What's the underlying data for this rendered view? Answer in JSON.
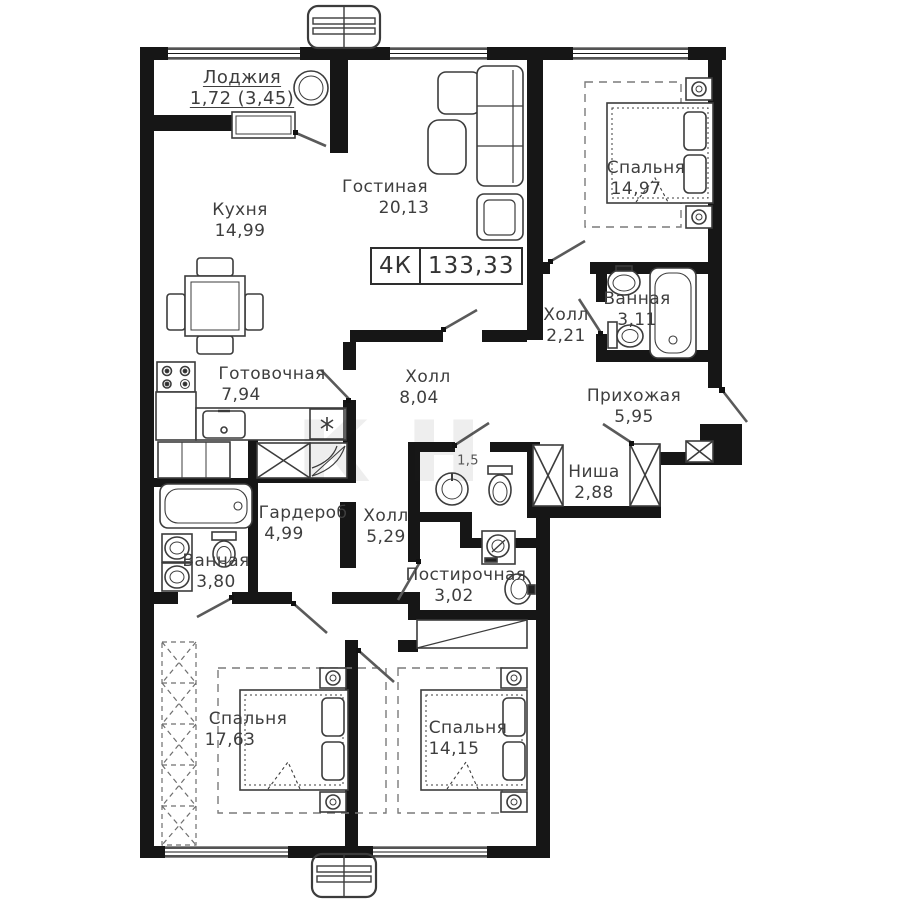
{
  "plan": {
    "badge": {
      "type": "4К",
      "area": "133,33"
    },
    "watermark": "кн",
    "rooms": [
      {
        "id": "loggia",
        "name": "Лоджия",
        "area": "1,72 (3,45)"
      },
      {
        "id": "kitchen",
        "name": "Кухня",
        "area": "14,99"
      },
      {
        "id": "living",
        "name": "Гостиная",
        "area": "20,13"
      },
      {
        "id": "bedroom-top",
        "name": "Спальня",
        "area": "14,97"
      },
      {
        "id": "bathroom-top",
        "name": "Ванная",
        "area": "3,11"
      },
      {
        "id": "hall-small",
        "name": "Холл",
        "area": "2,21"
      },
      {
        "id": "entry",
        "name": "Прихожая",
        "area": "5,95"
      },
      {
        "id": "cooking",
        "name": "Готовочная",
        "area": "7,94"
      },
      {
        "id": "hall-main",
        "name": "Холл",
        "area": "8,04"
      },
      {
        "id": "niche",
        "name": "Ниша",
        "area": "2,88"
      },
      {
        "id": "wardrobe",
        "name": "Гардероб",
        "area": "4,99"
      },
      {
        "id": "hall-lower",
        "name": "Холл",
        "area": "5,29"
      },
      {
        "id": "bathroom-lower",
        "name": "Ванная",
        "area": "3,80"
      },
      {
        "id": "wc",
        "name": "",
        "area": "1,5"
      },
      {
        "id": "laundry",
        "name": "Постирочная",
        "area": "3,02"
      },
      {
        "id": "bedroom-left",
        "name": "Спальня",
        "area": "17,63"
      },
      {
        "id": "bedroom-right",
        "name": "Спальня",
        "area": "14,15"
      }
    ]
  }
}
